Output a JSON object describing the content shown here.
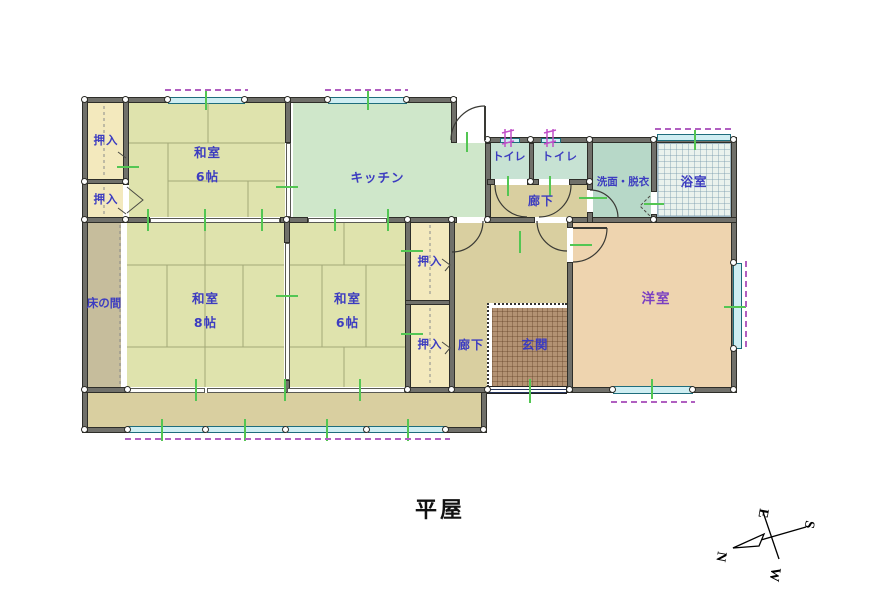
{
  "title": "平屋",
  "rooms": {
    "oshiire_tl1": {
      "name": "押入"
    },
    "oshiire_tl2": {
      "name": "押入"
    },
    "washitsu6_top": {
      "name": "和室",
      "size": "6帖"
    },
    "kitchen": {
      "name": "キッチン"
    },
    "toilet1": {
      "name": "トイレ"
    },
    "toilet2": {
      "name": "トイレ"
    },
    "senmen": {
      "name": "洗面・脱衣"
    },
    "bath": {
      "name": "浴室"
    },
    "hallway_top": {
      "name": "廊下"
    },
    "tokonoma": {
      "name": "床の間"
    },
    "washitsu8": {
      "name": "和室",
      "size": "8帖"
    },
    "washitsu6_mid": {
      "name": "和室",
      "size": "6帖"
    },
    "oshiire_m1": {
      "name": "押入"
    },
    "oshiire_m2": {
      "name": "押入"
    },
    "hallway_mid": {
      "name": "廊下"
    },
    "genkan": {
      "name": "玄関"
    },
    "yoshitsu": {
      "name": "洋室"
    }
  },
  "compass": {
    "north": "N",
    "south": "S",
    "east": "E",
    "west": "W"
  },
  "colors": {
    "tatami": "#dfe3ad",
    "closet": "#f3e9bd",
    "kitchen": "#cfe7ca",
    "toilet": "#c7e2d3",
    "senmen": "#b7d8c8",
    "bath_tile": "#eaf2ed",
    "corridor": "#d9cfa0",
    "tokonoma": "#c6bd9c",
    "western_room": "#eed4af",
    "genkan_floor": "#b39273",
    "wall": "#70706a",
    "label_blue": "#3c3cc0",
    "label_purple": "#7a3fc2",
    "window": "#cfeef2",
    "window_dash": "#b05fc0",
    "tick_green": "#53c653",
    "vent_magenta": "#c050c8"
  }
}
